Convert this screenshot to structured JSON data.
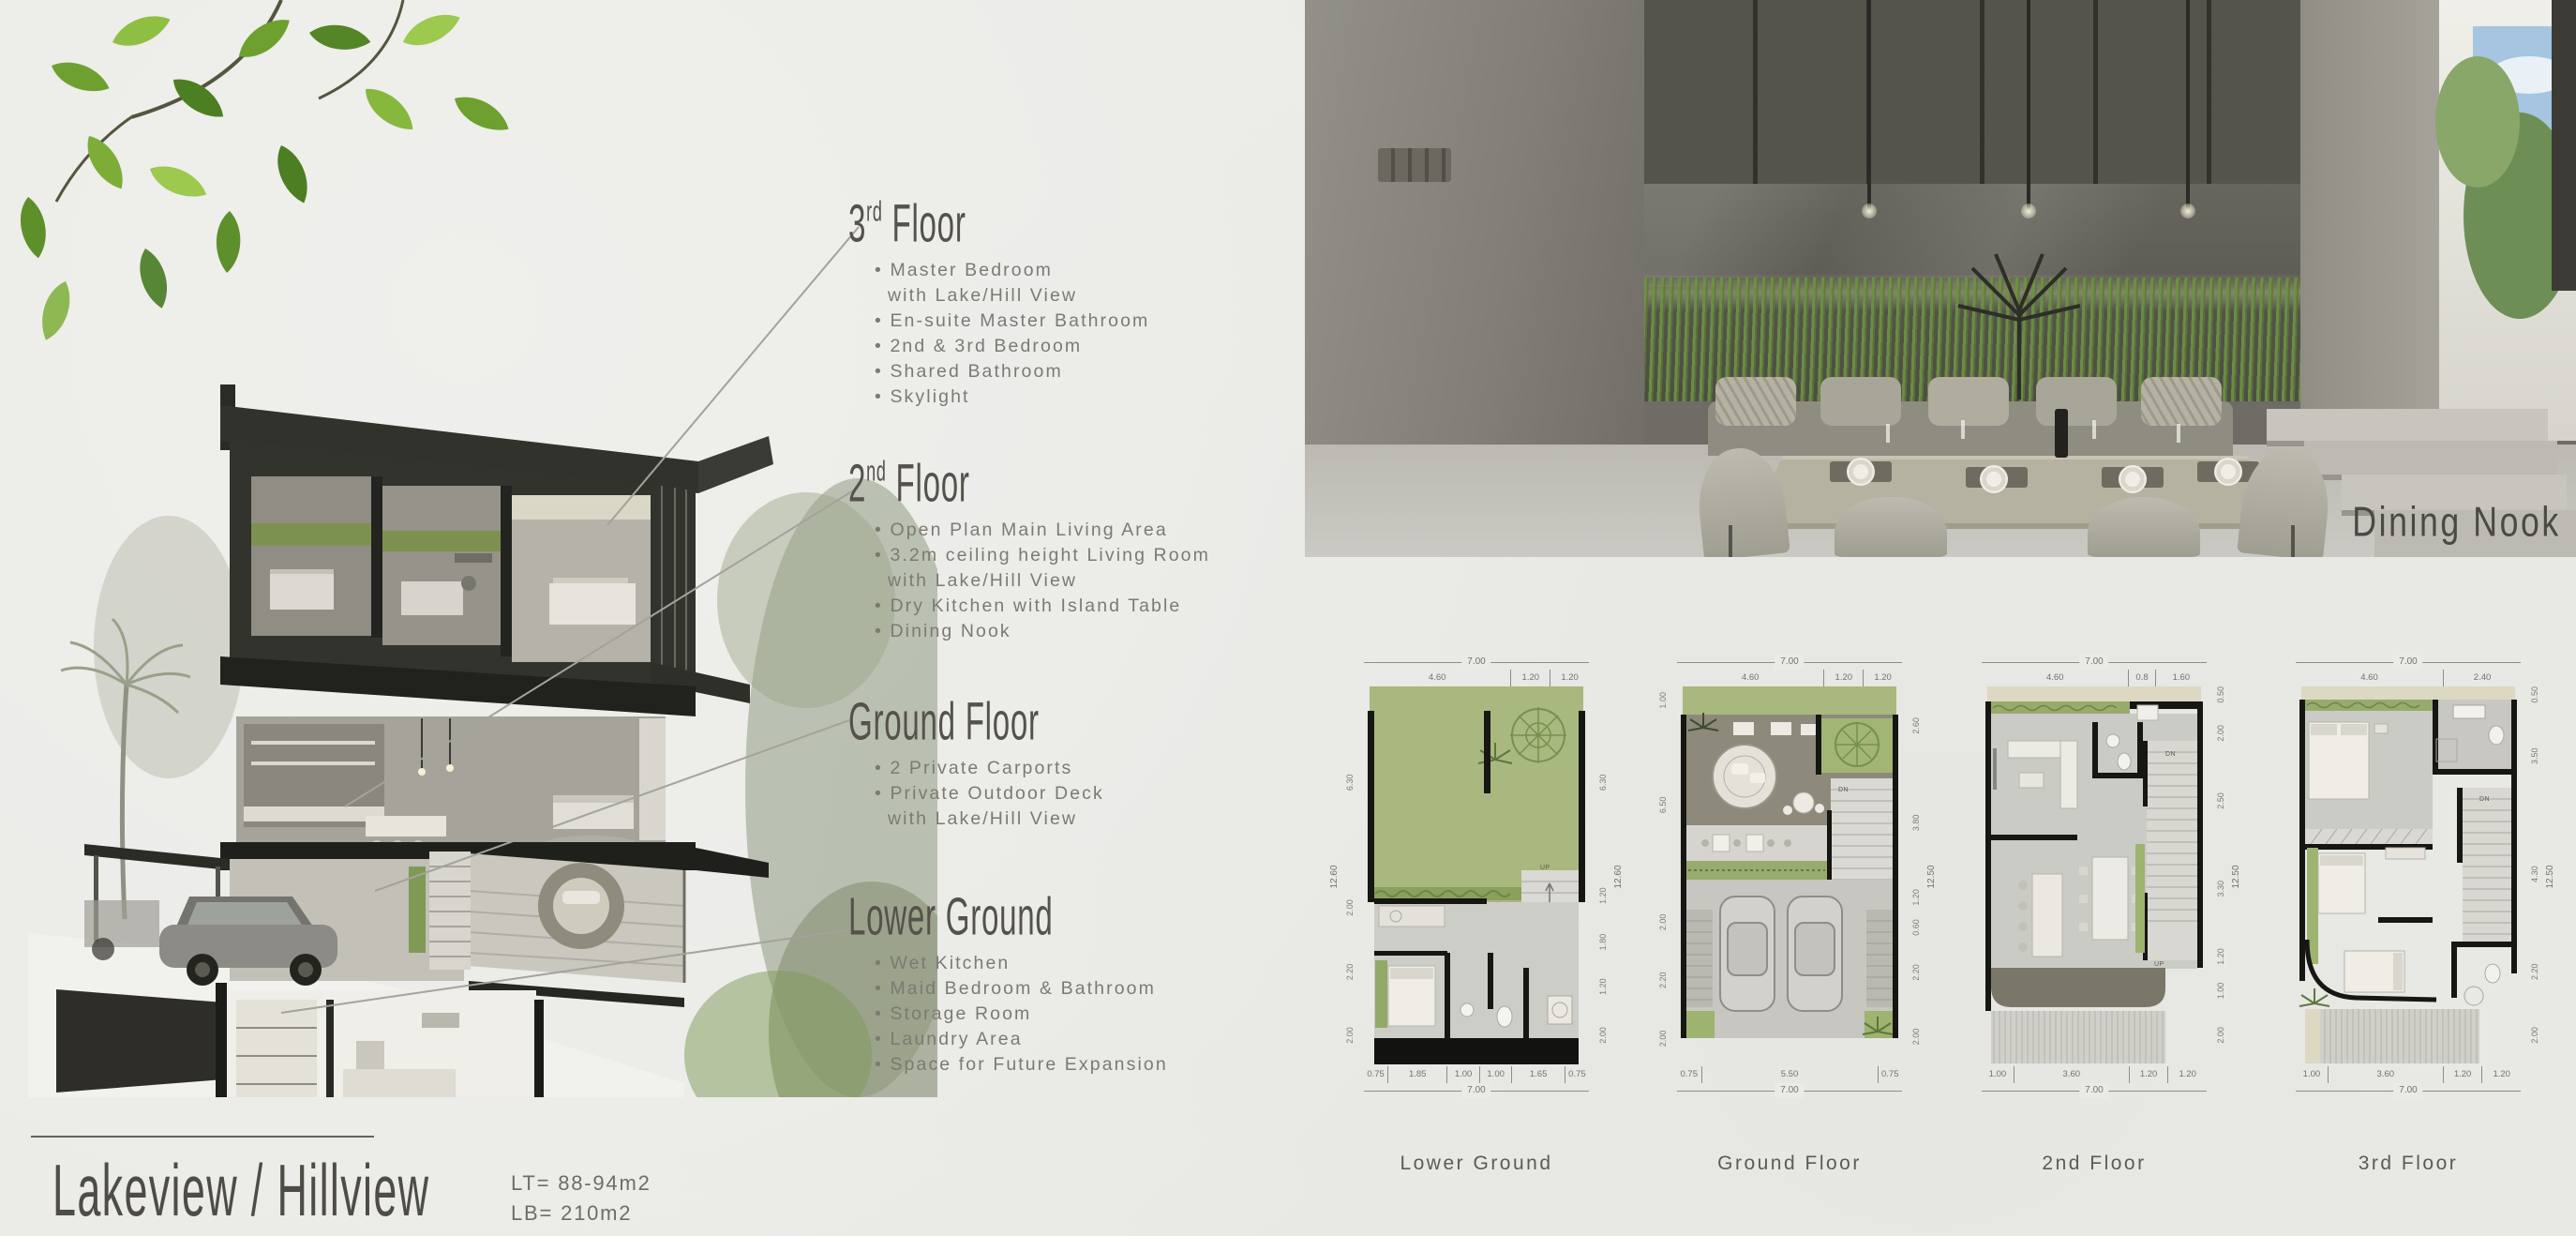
{
  "board": {
    "title": "Lakeview / Hillview",
    "lt": "LT= 88-94m2",
    "lb": "LB= 210m2"
  },
  "photo": {
    "label": "Dining Nook"
  },
  "sections": [
    {
      "num": "3",
      "sup": "rd",
      "rest": " Floor",
      "items": [
        {
          "text": "Master Bedroom"
        },
        {
          "text": "with Lake/Hill View",
          "cont": true
        },
        {
          "text": "En-suite Master Bathroom"
        },
        {
          "text": "2nd & 3rd Bedroom"
        },
        {
          "text": "Shared Bathroom"
        },
        {
          "text": "Skylight"
        }
      ]
    },
    {
      "num": "2",
      "sup": "nd",
      "rest": " Floor",
      "items": [
        {
          "text": "Open Plan Main Living Area"
        },
        {
          "text": "3.2m ceiling height Living Room"
        },
        {
          "text": "with Lake/Hill View",
          "cont": true
        },
        {
          "text": "Dry Kitchen with Island Table"
        },
        {
          "text": "Dining Nook"
        }
      ]
    },
    {
      "num": "Ground Floor",
      "sup": "",
      "rest": "",
      "items": [
        {
          "text": "2 Private Carports"
        },
        {
          "text": "Private Outdoor Deck"
        },
        {
          "text": "with Lake/Hill View",
          "cont": true
        }
      ]
    },
    {
      "num": "Lower Ground",
      "sup": "",
      "rest": "",
      "items": [
        {
          "text": "Wet Kitchen"
        },
        {
          "text": "Maid Bedroom & Bathroom"
        },
        {
          "text": "Storage Room"
        },
        {
          "text": "Laundry Area"
        },
        {
          "text": "Space for Future Expansion"
        }
      ]
    }
  ],
  "plans": [
    {
      "caption": "Lower Ground",
      "top_total": "7.00",
      "top_segs": [
        "4.60",
        "1.20",
        "1.20"
      ],
      "bottom_segs": [
        "0.75",
        "1.85",
        "1.00",
        "1.00",
        "1.65",
        "0.75"
      ],
      "bottom_total": "7.00",
      "left_total": "12.60",
      "left_segs": [
        "6.30",
        "2.00",
        "2.20",
        "2.00"
      ],
      "right_total": "12.60",
      "right_segs": [
        "6.30",
        "1.20",
        "1.80",
        "1.20",
        "2.00"
      ],
      "stair_up": "UP"
    },
    {
      "caption": "Ground Floor",
      "top_total": "7.00",
      "top_segs": [
        "4.60",
        "1.20",
        "1.20"
      ],
      "bottom_segs": [
        "0.75",
        "5.50",
        "0.75"
      ],
      "bottom_total": "7.00",
      "left_total": "12.50",
      "left_segs": [
        "1.00",
        "6.50",
        "2.00",
        "2.20",
        "2.00"
      ],
      "right_total": "12.50",
      "right_segs": [
        "2.60",
        "3.80",
        "1.20",
        "0.60",
        "2.20",
        "2.00"
      ],
      "stair_dn": "DN",
      "stair_up": "UP"
    },
    {
      "caption": "2nd Floor",
      "top_total": "7.00",
      "top_segs": [
        "4.60",
        "0.8",
        "1.60"
      ],
      "bottom_segs": [
        "1.00",
        "3.60",
        "1.20",
        "1.20"
      ],
      "bottom_total": "7.00",
      "right_total": "12.50",
      "right_segs": [
        "0.50",
        "2.00",
        "2.50",
        "3.30",
        "1.20",
        "1.00",
        "2.00"
      ],
      "stair_dn": "DN",
      "stair_up": "UP"
    },
    {
      "caption": "3rd Floor",
      "top_total": "7.00",
      "top_segs": [
        "4.60",
        "2.40"
      ],
      "bottom_segs": [
        "1.00",
        "3.60",
        "1.20",
        "1.20"
      ],
      "bottom_total": "7.00",
      "right_total": "12.50",
      "right_segs": [
        "0.50",
        "3.50",
        "4.30",
        "2.20",
        "2.00"
      ],
      "stair_dn": "DN"
    }
  ]
}
